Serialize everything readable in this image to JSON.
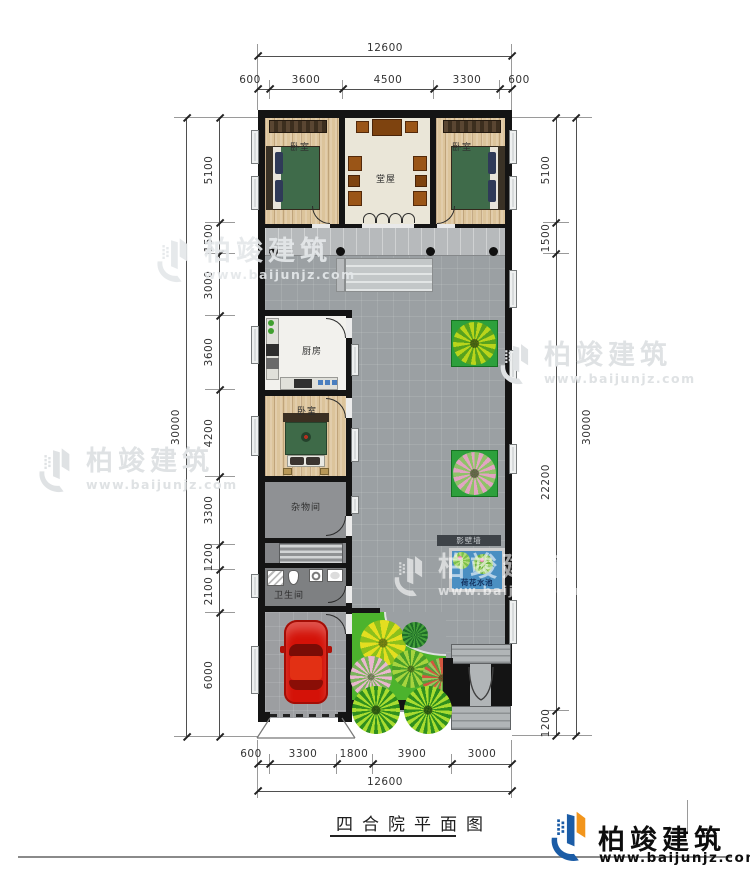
{
  "dimensions": {
    "top": {
      "total": "12600",
      "segments": [
        "600",
        "3600",
        "4500",
        "3300",
        "600"
      ]
    },
    "bottom": {
      "total": "12600",
      "segments": [
        "600",
        "3300",
        "1800",
        "3900",
        "3000"
      ]
    },
    "left": {
      "total": "30000",
      "segments": [
        "5100",
        "1500",
        "3000",
        "3600",
        "4200",
        "3300",
        "1200",
        "2100",
        "6000"
      ]
    },
    "right": {
      "total": "30000",
      "segments": [
        "5100",
        "1500",
        "22200",
        "1200"
      ]
    }
  },
  "rooms": {
    "bedroom_nw": "卧室",
    "hall": "堂屋",
    "bedroom_ne": "卧室",
    "kitchen": "厨房",
    "bedroom_w": "卧室",
    "storage": "杂物间",
    "bathroom": "卫生间"
  },
  "courtyard": {
    "screen_wall": "影壁墙",
    "lotus_pond": "荷花水池"
  },
  "watermark": {
    "brand": "柏竣建筑",
    "url": "www.baijunjz.com"
  },
  "title_block": {
    "drawing_title": "四合院平面图"
  },
  "logo": {
    "brand": "柏竣建筑",
    "url": "www.baijunjz.com"
  },
  "colors": {
    "wall": "#141414",
    "courtyard": "#9ba0a3",
    "garden": "#4cb32d",
    "pond": "#4a8fc2",
    "car": "#d41208",
    "logo_blue": "#1b5ca6",
    "logo_orange": "#f2951c"
  }
}
